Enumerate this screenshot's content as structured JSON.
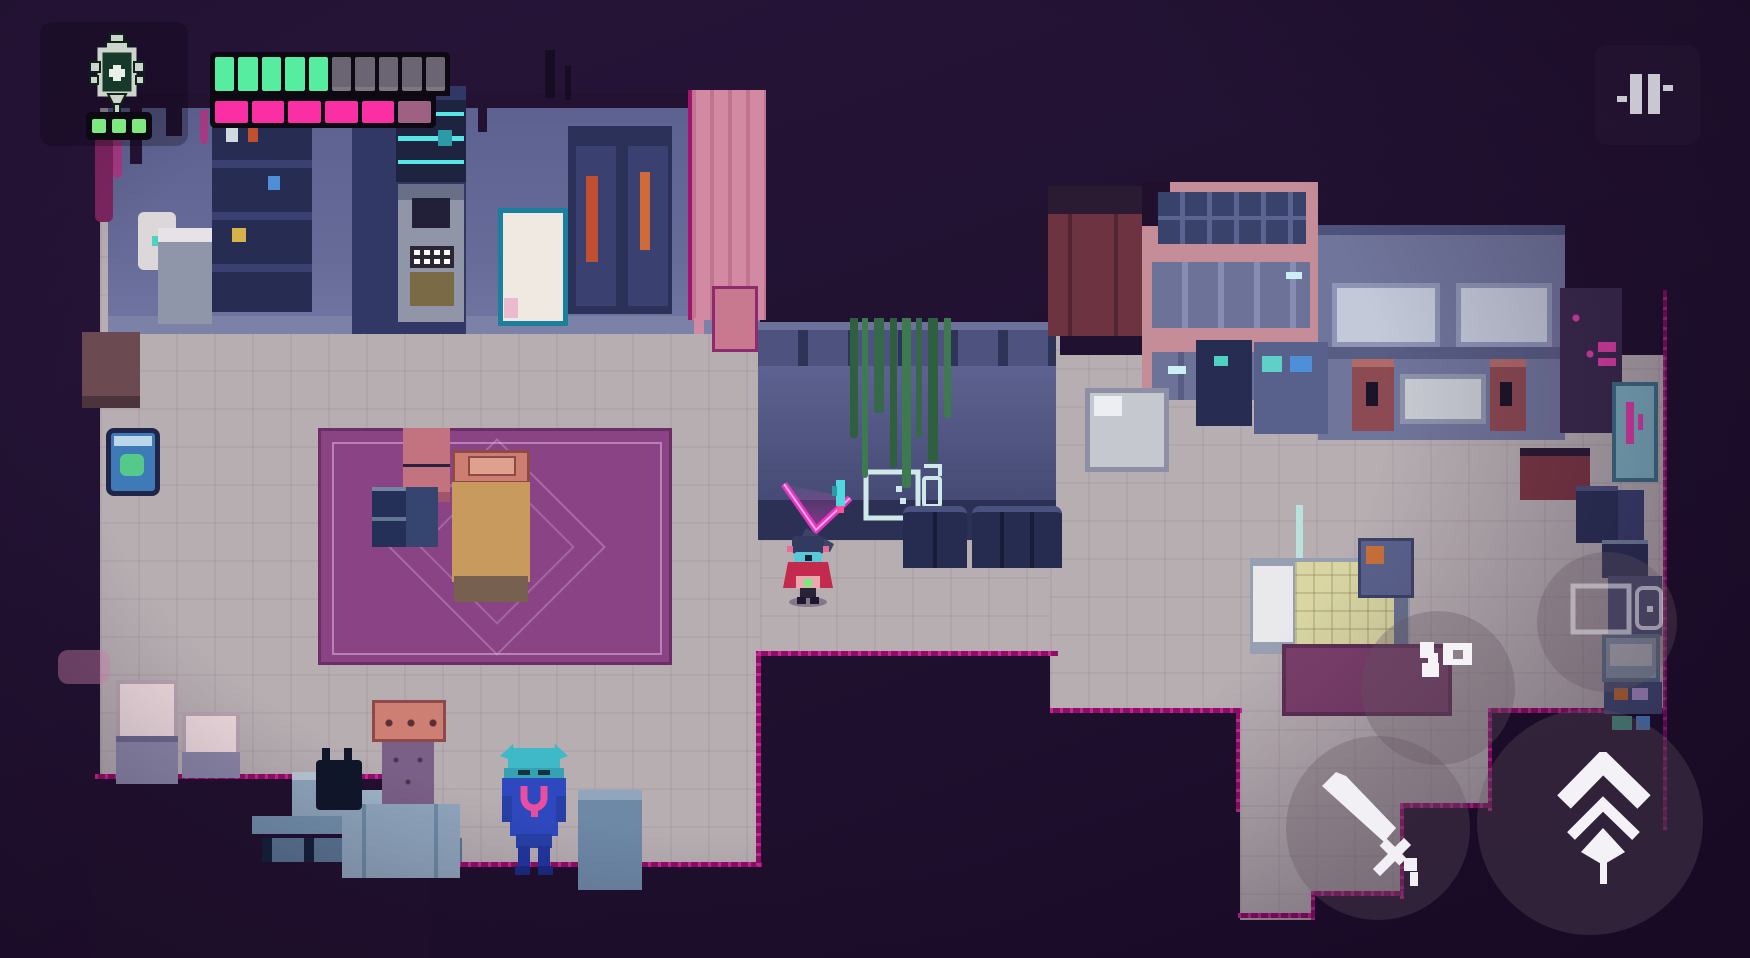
{
  "hud": {
    "medkit": {
      "icon": "syringe-medkit-icon",
      "doses_total": 3,
      "doses_filled": 3,
      "dose_color": "#7fe87f",
      "barrel_color": "#17392c",
      "outline_color": "#ccd4cc"
    },
    "health": {
      "segments_total": 10,
      "segments_filled": 5,
      "filled_color": "#57eda1",
      "empty_color": "#6b6472",
      "bar_bg": "#0c0912"
    },
    "energy": {
      "segments_total": 6,
      "segments_filled": 5,
      "has_charging_segment": true,
      "filled_color": "#fb2fa4",
      "charging_color": "#9c6183",
      "bar_bg": "#0c0912"
    },
    "pause": {
      "icon": "pause-icon",
      "bar_color": "#c9c7cf"
    }
  },
  "touch_controls": {
    "attack": {
      "icon": "sword-icon",
      "icon_color": "#f2f0f4"
    },
    "dash": {
      "icon": "double-chevron-up-arrow-icon",
      "icon_color": "#f4f2f6"
    },
    "gun": {
      "icon": "pistol-icon",
      "icon_color": "#f5f3f6"
    },
    "gear": {
      "icon": "holster-slots-icon",
      "icon_color": "rgba(226,222,230,0.55)"
    },
    "button_fill": "rgba(100,85,95,0.32)"
  },
  "scene": {
    "palette": {
      "background": "#20102e",
      "floor": "#b7aeb2",
      "wall": "#5c6190",
      "carpet": "#8a4486",
      "trim_magenta": "#9c1072",
      "trim_bright": "#d12b94",
      "vine_green": "#3e7a50",
      "pink_building": "#c48d98",
      "beam_magenta": "#ff3fd4"
    },
    "entities": {
      "player": "red-cloaked-drifter",
      "companion": "cyan-drone-with-magenta-beam",
      "npc": "blue-horned-villager"
    }
  }
}
